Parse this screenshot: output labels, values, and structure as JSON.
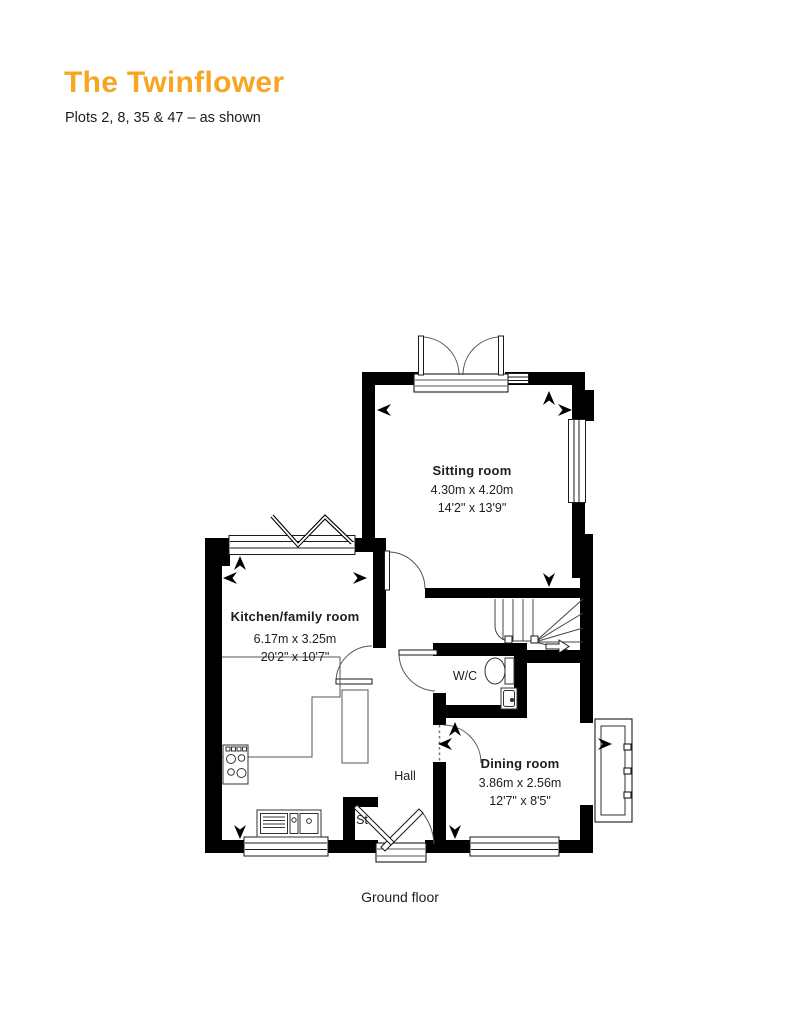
{
  "header": {
    "title": "The Twinflower",
    "subtitle": "Plots 2, 8, 35 & 47 – as shown"
  },
  "floor_caption": "Ground floor",
  "rooms": {
    "sitting": {
      "name": "Sitting room",
      "metric": "4.30m x 4.20m",
      "imperial": "14'2\" x 13'9\""
    },
    "kitchen": {
      "name": "Kitchen/family room",
      "metric": "6.17m x 3.25m",
      "imperial": "20'2\" x 10'7\""
    },
    "dining": {
      "name": "Dining room",
      "metric": "3.86m x 2.56m",
      "imperial": "12'7\" x 8'5\""
    },
    "wc": {
      "name": "W/C"
    },
    "hall": {
      "name": "Hall"
    },
    "store": {
      "name": "St"
    }
  },
  "colors": {
    "accent": "#F6A623",
    "text": "#1D1D1D",
    "walls": "#000000"
  }
}
